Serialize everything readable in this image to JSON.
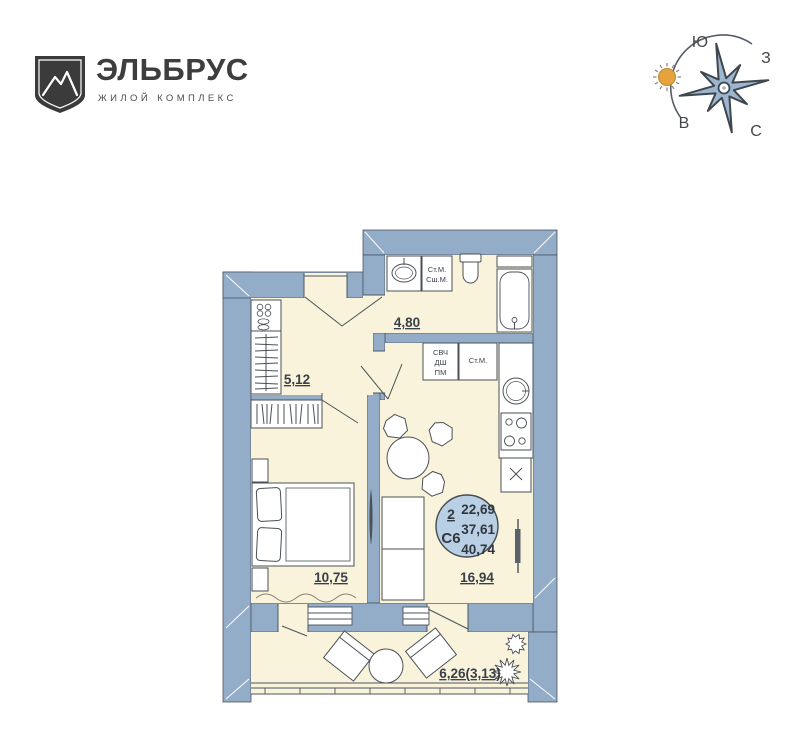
{
  "brand": {
    "name": "ЭЛЬБРУС",
    "tagline": "ЖИЛОЙ КОМПЛЕКС"
  },
  "compass": {
    "south": "Ю",
    "west": "З",
    "east": "В",
    "north": "С"
  },
  "plan": {
    "badge": {
      "rooms": "2",
      "unit": "С6",
      "living_area": "22,69",
      "apartment_area": "37,61",
      "total_area": "40,74"
    },
    "areas": {
      "bathroom": "4,80",
      "hall": "5,12",
      "bedroom": "10,75",
      "kitchen_living": "16,94",
      "balcony": "6,26(3,13)"
    },
    "appliances": {
      "bath_washer": "Ст.М.",
      "bath_dryer": "Сш.М.",
      "microwave": "СВЧ",
      "oven": "ДШ",
      "dishwasher": "ПМ",
      "kitchen_washer": "Ст.М."
    },
    "colors": {
      "wall": "#93acc8",
      "floor": "#faf3dc",
      "badge_fill": "#b9cfe3",
      "star": "#9db6cf",
      "sun": "#e6a33d"
    }
  }
}
